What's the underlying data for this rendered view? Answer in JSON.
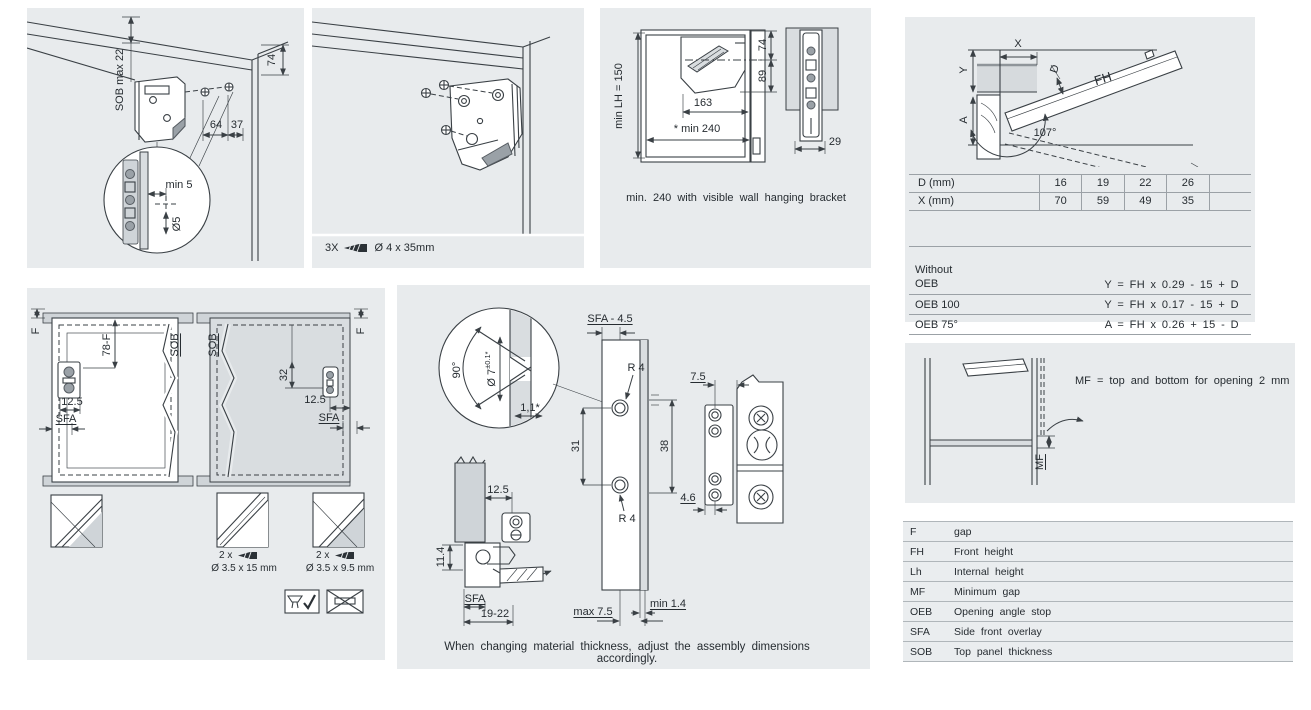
{
  "p1": {
    "sob_max": "SOB max 22",
    "dim_74": "74",
    "dim_64": "64",
    "dim_37": "37",
    "dim_min5": "min 5",
    "dim_dia5": "Ø5"
  },
  "p2": {
    "screw_qty": "3X",
    "screw_size": "Ø 4 x 35mm"
  },
  "p3": {
    "dim_lh": "min LH = 150",
    "dim_74": "74",
    "dim_89": "89",
    "dim_163": "163",
    "dim_min240": "* min 240",
    "dim_29": "29",
    "caption": "min. 240 with visible wall hanging bracket"
  },
  "p4": {
    "label_x": "X",
    "label_y": "Y",
    "label_a": "A",
    "label_d": "D",
    "label_fh": "FH",
    "label_angle": "107°",
    "table": {
      "rows": [
        {
          "label": "D (mm)",
          "values": [
            "16",
            "19",
            "22",
            "26",
            ""
          ]
        },
        {
          "label": "X (mm)",
          "values": [
            "70",
            "59",
            "49",
            "35",
            ""
          ]
        }
      ]
    },
    "formulas": [
      {
        "label": "Without\nOEB",
        "formula": "Y = FH x 0.29 - 15 + D"
      },
      {
        "label": "OEB 100",
        "formula": "Y = FH x 0.17 - 15 + D"
      },
      {
        "label": "OEB 75°",
        "formula": "A = FH x 0.26 + 15 - D"
      }
    ]
  },
  "p5": {
    "label_mf": "MF",
    "note": "MF = top and bottom for opening 2 mm"
  },
  "legend": {
    "rows": [
      {
        "abbr": "F",
        "desc": "gap"
      },
      {
        "abbr": "FH",
        "desc": "Front height"
      },
      {
        "abbr": "Lh",
        "desc": "Internal height"
      },
      {
        "abbr": "MF",
        "desc": "Minimum gap"
      },
      {
        "abbr": "OEB",
        "desc": "Opening angle stop"
      },
      {
        "abbr": "SFA",
        "desc": "Side front overlay"
      },
      {
        "abbr": "SOB",
        "desc": "Top panel thickness"
      }
    ]
  },
  "p6": {
    "f_left": "F",
    "dim_78f": "78-F",
    "sob_left": "SOB",
    "dim_125_left": "12.5",
    "sfa_left": "SFA",
    "sob_right": "SOB",
    "dim_32": "32",
    "dim_125_right": "12.5",
    "sfa_right": "SFA",
    "f_right": "F",
    "screw15_qty": "2 x",
    "screw15_size": "Ø 3.5 x 15 mm",
    "screw95_qty": "2 x",
    "screw95_size": "Ø 3.5 x 9.5 mm"
  },
  "p7": {
    "sfa45": "SFA - 4.5",
    "deg90": "90°",
    "dia7": "Ø 7",
    "tol": "±0.1*",
    "dim_11": "1,1*",
    "r4_top": "R 4",
    "r4_bot": "R 4",
    "dim_31": "31",
    "dim_38": "38",
    "dim_75": "7.5",
    "dim_46": "4.6",
    "dim_125": "12.5",
    "dim_114": "11.4",
    "sfa": "SFA",
    "dim_1922": "19-22",
    "max75": "max 7.5",
    "min14": "min 1.4",
    "caption": "When changing material thickness, adjust the assembly dimensions accordingly."
  }
}
